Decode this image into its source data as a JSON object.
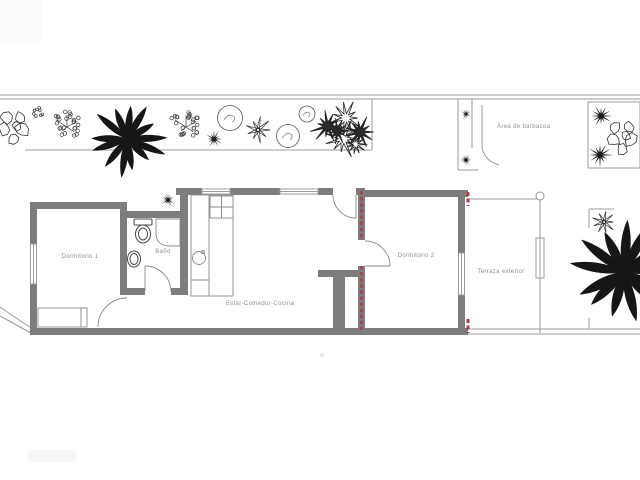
{
  "plan_title": "Floor plan with garden",
  "labels": {
    "area_barbacoa": "Área de barbacoa",
    "dormitorio_1": "Dormitorio 1",
    "bano": "Baño",
    "estar_comedor_cocina": "Estar-Comedor-Cocina",
    "dormitorio_2": "Dormitorio 2",
    "terraza_exterior": "Terraza exterior"
  },
  "colors": {
    "background": "#ffffff",
    "wall": "#7d7d7d",
    "thin_line": "#9b9b9b",
    "fixture_line": "#8a8a8a",
    "red_accent": "#b23b48",
    "label_text": "#8f8f8f",
    "plant_dark": "#161616",
    "plant_line": "#3c3c3c"
  },
  "garden": {
    "plants": [
      {
        "name": "rock-cluster-icon",
        "type": "rocks",
        "x": 15,
        "y": 128,
        "s": 34,
        "seed": 1
      },
      {
        "name": "flower-cluster-icon",
        "type": "flowers",
        "x": 38,
        "y": 112,
        "s": 15,
        "seed": 2
      },
      {
        "name": "shrub-branch-icon",
        "type": "sprig",
        "x": 67,
        "y": 127,
        "s": 40,
        "seed": 3
      },
      {
        "name": "palm-tree-icon",
        "type": "palm",
        "x": 127,
        "y": 139,
        "s": 72,
        "seed": 4
      },
      {
        "name": "shrub-branch-icon",
        "type": "sprig",
        "x": 186,
        "y": 127,
        "s": 40,
        "seed": 5
      },
      {
        "name": "dark-flower-icon",
        "type": "spiky",
        "x": 214,
        "y": 139,
        "s": 16,
        "seed": 6
      },
      {
        "name": "round-bush-icon",
        "type": "bush",
        "x": 230,
        "y": 118,
        "s": 25,
        "seed": 7
      },
      {
        "name": "star-plant-icon",
        "type": "star",
        "x": 258,
        "y": 130,
        "s": 24,
        "seed": 8
      },
      {
        "name": "round-bush-icon",
        "type": "bush",
        "x": 288,
        "y": 136,
        "s": 23,
        "seed": 9
      },
      {
        "name": "round-bush-icon",
        "type": "bush",
        "x": 307,
        "y": 114,
        "s": 16,
        "seed": 10
      },
      {
        "name": "spiky-bush-cluster-icon",
        "type": "spikyCluster",
        "x": 343,
        "y": 132,
        "s": 56,
        "seed": 11
      },
      {
        "name": "potted-plant-icon",
        "type": "spiky",
        "x": 466,
        "y": 114,
        "s": 10,
        "seed": 12
      },
      {
        "name": "potted-plant-icon",
        "type": "spiky",
        "x": 466,
        "y": 160,
        "s": 11,
        "seed": 13
      },
      {
        "name": "wall-plant-icon",
        "type": "spiky",
        "x": 168,
        "y": 200,
        "s": 13,
        "seed": 14
      },
      {
        "name": "star-plant-icon",
        "type": "spiky",
        "x": 601,
        "y": 116,
        "s": 20,
        "seed": 15
      },
      {
        "name": "star-plant-icon",
        "type": "spiky",
        "x": 600,
        "y": 155,
        "s": 22,
        "seed": 16
      },
      {
        "name": "rock-cluster-icon",
        "type": "rocks",
        "x": 624,
        "y": 138,
        "s": 34,
        "seed": 17
      },
      {
        "name": "star-flower-icon",
        "type": "star",
        "x": 604,
        "y": 222,
        "s": 22,
        "seed": 18
      },
      {
        "name": "palm-tree-icon",
        "type": "palm",
        "x": 624,
        "y": 272,
        "s": 100,
        "seed": 19
      }
    ]
  }
}
